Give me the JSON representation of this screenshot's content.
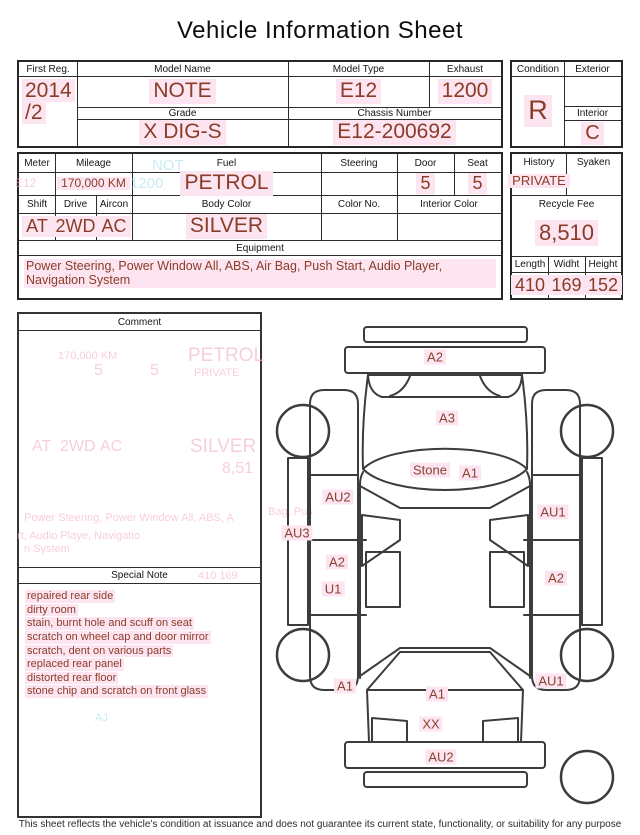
{
  "title": "Vehicle Information Sheet",
  "colors": {
    "value_text": "#8a3c28",
    "highlight": "#fce5f0",
    "line": "#3c3c3c",
    "ghost_pink": "#f4b6d2",
    "ghost_cyan": "#aee3ea"
  },
  "table1": {
    "first_reg": {
      "label": "First Reg.",
      "value_line1": "2014",
      "value_line2": "/2"
    },
    "model_name": {
      "label": "Model Name",
      "value": "NOTE"
    },
    "model_type": {
      "label": "Model Type",
      "value": "E12"
    },
    "exhaust": {
      "label": "Exhaust",
      "value": "1200"
    },
    "grade": {
      "label": "Grade",
      "value": "X DIG-S"
    },
    "chassis_number": {
      "label": "Chassis Number",
      "value": "E12-200692"
    },
    "condition": {
      "label": "Condition",
      "value": "R"
    },
    "exterior": {
      "label": "Exterior",
      "value": ""
    },
    "interior": {
      "label": "Interior",
      "value": "C"
    }
  },
  "table2": {
    "meter": {
      "label": "Meter",
      "value": ""
    },
    "mileage": {
      "label": "Mileage",
      "value": "170,000 KM"
    },
    "fuel": {
      "label": "Fuel",
      "value": "PETROL"
    },
    "steering": {
      "label": "Steering",
      "value": ""
    },
    "door": {
      "label": "Door",
      "value": "5"
    },
    "seat": {
      "label": "Seat",
      "value": "5"
    },
    "shift": {
      "label": "Shift",
      "value": "AT"
    },
    "drive": {
      "label": "Drive",
      "value": "2WD"
    },
    "aircon": {
      "label": "Aircon",
      "value": "AC"
    },
    "body_color": {
      "label": "Body Color",
      "value": "SILVER"
    },
    "color_no": {
      "label": "Color No.",
      "value": ""
    },
    "interior_color": {
      "label": "Interior Color",
      "value": ""
    },
    "equipment": {
      "label": "Equipment",
      "value": "Power Steering, Power Window  All, ABS, Air Bag, Push Start, Audio Player, Navigation System"
    }
  },
  "sidebar": {
    "history": {
      "label": "History",
      "value": "PRIVATE"
    },
    "syaken": {
      "label": "Syaken",
      "value": ""
    },
    "recycle_fee": {
      "label": "Recycle Fee",
      "value": "8,510"
    },
    "length": {
      "label": "Length",
      "value": "410"
    },
    "width": {
      "label": "Widht",
      "value": "169"
    },
    "height": {
      "label": "Height",
      "value": "152"
    }
  },
  "comment": {
    "label": "Comment"
  },
  "special_note": {
    "label": "Special Note",
    "lines": [
      "repaired rear side",
      "dirty room",
      "stain, burnt hole and scuff on seat",
      "scratch on wheel cap and door mirror",
      "scratch, dent on various parts",
      "replaced rear panel",
      "distorted rear floor",
      "stone chip and scratch on front glass"
    ]
  },
  "diagram": {
    "labels": [
      {
        "text": "A2",
        "x": 435,
        "y": 357
      },
      {
        "text": "A3",
        "x": 447,
        "y": 418
      },
      {
        "text": "Stone",
        "x": 430,
        "y": 470
      },
      {
        "text": "A1",
        "x": 470,
        "y": 473
      },
      {
        "text": "AU2",
        "x": 338,
        "y": 497
      },
      {
        "text": "AU3",
        "x": 297,
        "y": 533
      },
      {
        "text": "AU1",
        "x": 553,
        "y": 512
      },
      {
        "text": "A2",
        "x": 337,
        "y": 562
      },
      {
        "text": "U1",
        "x": 333,
        "y": 589
      },
      {
        "text": "A2",
        "x": 556,
        "y": 578
      },
      {
        "text": "A1",
        "x": 345,
        "y": 686
      },
      {
        "text": "A1",
        "x": 437,
        "y": 694
      },
      {
        "text": "AU1",
        "x": 551,
        "y": 681
      },
      {
        "text": "XX",
        "x": 431,
        "y": 724
      },
      {
        "text": "AU2",
        "x": 441,
        "y": 757
      }
    ]
  },
  "ghost_text": [
    {
      "text": "NOT",
      "x": 152,
      "y": 157,
      "size": 15,
      "color": "cyan"
    },
    {
      "text": "1200",
      "x": 130,
      "y": 175,
      "size": 15,
      "color": "cyan"
    },
    {
      "text": "E12",
      "x": 15,
      "y": 176,
      "size": 12,
      "color": "pink"
    },
    {
      "text": "170,000 KM",
      "x": 58,
      "y": 350,
      "size": 11,
      "color": "pink"
    },
    {
      "text": "5",
      "x": 94,
      "y": 362,
      "size": 16,
      "color": "pink"
    },
    {
      "text": "5",
      "x": 150,
      "y": 362,
      "size": 16,
      "color": "pink"
    },
    {
      "text": "PETROL",
      "x": 188,
      "y": 345,
      "size": 19,
      "color": "pink"
    },
    {
      "text": "PRIVATE",
      "x": 194,
      "y": 367,
      "size": 11,
      "color": "pink"
    },
    {
      "text": "AT",
      "x": 32,
      "y": 438,
      "size": 16,
      "color": "pink"
    },
    {
      "text": "2WD",
      "x": 60,
      "y": 438,
      "size": 16,
      "color": "pink"
    },
    {
      "text": "AC",
      "x": 100,
      "y": 438,
      "size": 16,
      "color": "pink"
    },
    {
      "text": "SILVER",
      "x": 190,
      "y": 436,
      "size": 19,
      "color": "pink"
    },
    {
      "text": "8,51",
      "x": 222,
      "y": 460,
      "size": 16,
      "color": "pink"
    },
    {
      "text": "Power Steering, Power Window  All, ABS, A",
      "x": 24,
      "y": 512,
      "size": 11,
      "color": "pink"
    },
    {
      "text": "rt, Audio Playe, Navigatio",
      "x": 17,
      "y": 530,
      "size": 11,
      "color": "pink"
    },
    {
      "text": "n System",
      "x": 24,
      "y": 543,
      "size": 11,
      "color": "pink"
    },
    {
      "text": "410   169",
      "x": 198,
      "y": 570,
      "size": 11,
      "color": "pink"
    },
    {
      "text": "Bag, Pus",
      "x": 268,
      "y": 506,
      "size": 11,
      "color": "pink"
    },
    {
      "text": "AJ",
      "x": 95,
      "y": 712,
      "size": 11,
      "color": "cyan"
    }
  ],
  "footer": "This sheet reflects the vehicle's condition at issuance and does not guarantee its current state, functionality, or suitability for any purpose"
}
